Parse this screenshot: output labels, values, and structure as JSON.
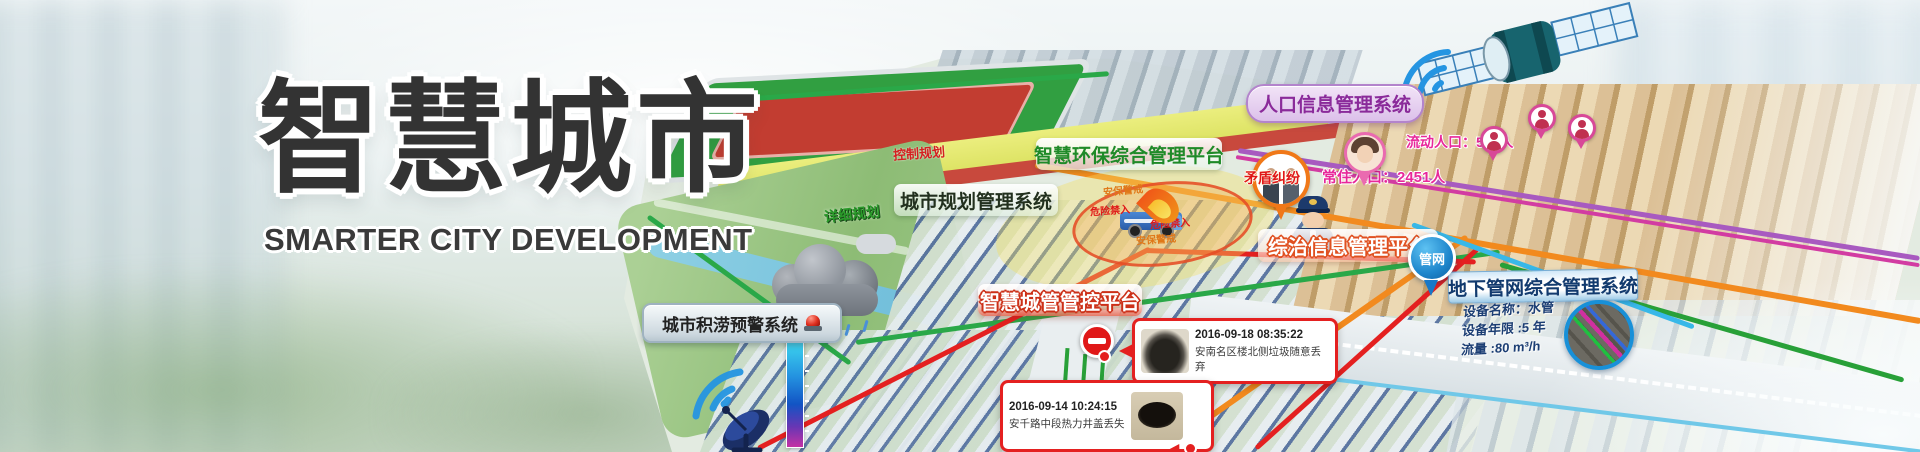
{
  "banner": {
    "title": "智慧城市",
    "subtitle": "SMARTER CITY DEVELOPMENT"
  },
  "system_labels": {
    "flood_warning": "城市积涝预警系统",
    "env_platform": "智慧环保综合管理平台",
    "urban_planning": "城市规划管理系统",
    "population": "人口信息管理系统",
    "governance": "综治信息管理平台",
    "city_mgmt": "智慧城管管控平台",
    "pipe_network": "地下管网综合管理系统"
  },
  "map_annotations": {
    "control_planning": "控制规划",
    "detailed_planning": "详细规划",
    "security_alert": "安保警戒",
    "danger_no_entry": "危险禁入",
    "dispute": "矛盾纠纷",
    "resident_population": "常住人口：2451人",
    "floating_population": "流动人口：533人",
    "pipe_pin": "管网"
  },
  "pipe_info": {
    "device_name": "设备名称：水管",
    "device_age": "设备年限 :5 年",
    "flow": "流量 :80 m³/h"
  },
  "incidents": [
    {
      "time": "2016-09-18 08:35:22",
      "desc": "安南名区楼北侧垃圾随意丢弃"
    },
    {
      "time": "2016-09-14 10:24:15",
      "desc": "安千路中段热力井盖丢失"
    }
  ],
  "colors": {
    "alert_red": "#e42020",
    "route_orange": "#f28a1e",
    "route_green": "#2aa848",
    "route_purple": "#b05cc0",
    "population_pink": "#e8289a",
    "pipe_blue": "#1890d8"
  }
}
